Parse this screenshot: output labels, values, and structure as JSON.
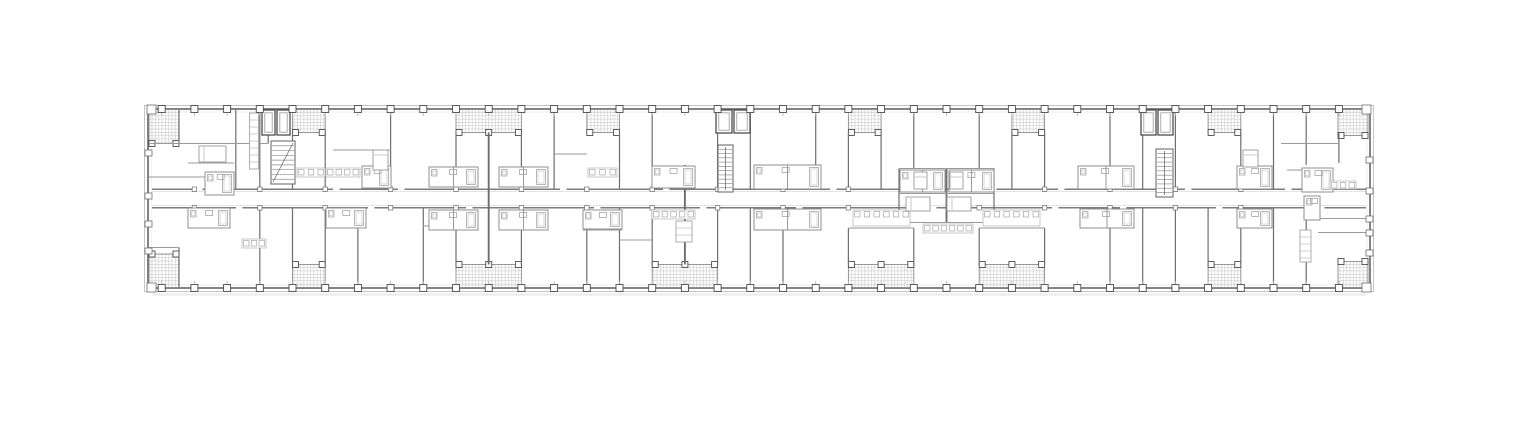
{
  "canvas": {
    "width": 1520,
    "height": 435,
    "background": "#ffffff"
  },
  "plan": {
    "type": "architectural-floor-plan",
    "style": {
      "wall": "#6e6e6e",
      "roomWall": "#9a9a9a",
      "thinWall": "#8f8f8f",
      "fine": "#b3b3b3",
      "hatch": "#c9c9c9",
      "balconyBorder": "#8d8d8d",
      "colStroke": "#4e4e4e",
      "corridor": "#7c7c7c",
      "corridorInner": "#dcdcdc",
      "outerLight": "#c6c6c6",
      "innerFace": "#e6e6e6",
      "fixture": "#9a9a9a",
      "ground": "#ededed",
      "paper": "#ffffff"
    },
    "building": {
      "outer": {
        "x": 144.5,
        "y": 105.5,
        "w": 1229,
        "h": 186
      },
      "inner": {
        "x": 148,
        "y": 109,
        "w": 1222,
        "h": 179
      },
      "groundY": 294.5
    },
    "grid": {
      "columns": [
        161.7,
        194.4,
        227.1,
        259.8,
        292.5,
        325.2,
        357.9,
        390.6,
        423.3,
        456,
        488.7,
        521.4,
        554.1,
        586.8,
        619.5,
        652.2,
        684.9,
        717.6,
        750.3,
        783,
        815.7,
        848.4,
        881.1,
        913.8,
        946.5,
        979.2,
        1011.9,
        1044.6,
        1077.3,
        1110,
        1142.7,
        1175.4,
        1208.1,
        1240.8,
        1273.5,
        1306.2,
        1338.9
      ],
      "colSize": 7,
      "topY": 109,
      "bottomY": 288
    },
    "corridor": {
      "x1": 152,
      "x2": 1366,
      "topY": 189.2,
      "botY": 207.8,
      "gapW": 6.5,
      "topGaps": [
        196,
        333,
        398,
        560,
        663,
        830,
        990,
        1058,
        1185,
        1285
      ],
      "botGaps": [
        236,
        368,
        466,
        594,
        700,
        796,
        930,
        1052,
        1120,
        1216,
        1318
      ]
    },
    "balconies": {
      "top": [
        {
          "x": 149,
          "y": 109.5,
          "w": 30,
          "h": 34
        },
        {
          "x": 292.5,
          "y": 109.5,
          "w": 32.7,
          "h": 23
        },
        {
          "x": 456,
          "y": 109.5,
          "w": 65.4,
          "h": 23,
          "mid": 488.7
        },
        {
          "x": 586.8,
          "y": 109.5,
          "w": 32.7,
          "h": 23
        },
        {
          "x": 848.4,
          "y": 109.5,
          "w": 32.7,
          "h": 23
        },
        {
          "x": 1011.9,
          "y": 109.5,
          "w": 32.7,
          "h": 23
        },
        {
          "x": 1208.1,
          "y": 109.5,
          "w": 32.7,
          "h": 23
        },
        {
          "x": 1338,
          "y": 109.5,
          "w": 30,
          "h": 26
        }
      ],
      "bottom": [
        {
          "x": 149,
          "y": 254,
          "w": 30,
          "h": 33.5
        },
        {
          "x": 292.5,
          "y": 264.5,
          "w": 32.7,
          "h": 23
        },
        {
          "x": 456,
          "y": 264.5,
          "w": 65.4,
          "h": 23,
          "mid": 488.7
        },
        {
          "x": 652.2,
          "y": 264.5,
          "w": 65.4,
          "h": 23,
          "mid": 684.9
        },
        {
          "x": 848.4,
          "y": 264.5,
          "w": 65.4,
          "h": 23,
          "mid": 881.1
        },
        {
          "x": 979.2,
          "y": 264.5,
          "w": 65.4,
          "h": 23,
          "mid": 1011.9
        },
        {
          "x": 1208.1,
          "y": 264.5,
          "w": 32.7,
          "h": 23
        },
        {
          "x": 1338,
          "y": 261.5,
          "w": 30,
          "h": 26
        }
      ]
    },
    "wallsV": [
      {
        "x": 179,
        "y1": 110,
        "y2": 143.5
      },
      {
        "x": 268.2,
        "y1": 110,
        "y2": 143.5
      },
      {
        "x": 235.8,
        "y1": 110,
        "y2": 189
      },
      {
        "x": 259.8,
        "y1": 110,
        "y2": 189
      },
      {
        "x": 292.5,
        "y1": 132.5,
        "y2": 189
      },
      {
        "x": 325.2,
        "y1": 132.5,
        "y2": 189
      },
      {
        "x": 390.6,
        "y1": 110,
        "y2": 189
      },
      {
        "x": 456,
        "y1": 132.5,
        "y2": 189
      },
      {
        "x": 521.4,
        "y1": 132.5,
        "y2": 189
      },
      {
        "x": 554.1,
        "y1": 110,
        "y2": 189
      },
      {
        "x": 619.5,
        "y1": 132.5,
        "y2": 189
      },
      {
        "x": 652.2,
        "y1": 110,
        "y2": 189
      },
      {
        "x": 717.6,
        "y1": 110,
        "y2": 189
      },
      {
        "x": 750.3,
        "y1": 110,
        "y2": 189
      },
      {
        "x": 815.7,
        "y1": 110,
        "y2": 189
      },
      {
        "x": 848.4,
        "y1": 132.5,
        "y2": 189
      },
      {
        "x": 881.1,
        "y1": 132.5,
        "y2": 189
      },
      {
        "x": 913.8,
        "y1": 110,
        "y2": 168.5
      },
      {
        "x": 979.2,
        "y1": 110,
        "y2": 168.5
      },
      {
        "x": 1011.9,
        "y1": 132.5,
        "y2": 189
      },
      {
        "x": 1044.6,
        "y1": 132.5,
        "y2": 189
      },
      {
        "x": 1110,
        "y1": 110,
        "y2": 189
      },
      {
        "x": 1142.7,
        "y1": 110,
        "y2": 189
      },
      {
        "x": 1175.4,
        "y1": 110,
        "y2": 189
      },
      {
        "x": 1240.8,
        "y1": 132.5,
        "y2": 189
      },
      {
        "x": 1273.5,
        "y1": 110,
        "y2": 189
      },
      {
        "x": 1306.2,
        "y1": 110,
        "y2": 165
      },
      {
        "x": 1338.9,
        "y1": 133,
        "y2": 163
      },
      {
        "x": 259.8,
        "y1": 208,
        "y2": 287
      },
      {
        "x": 292.5,
        "y1": 208,
        "y2": 264.5
      },
      {
        "x": 325.2,
        "y1": 208,
        "y2": 264.5
      },
      {
        "x": 357.9,
        "y1": 208,
        "y2": 287
      },
      {
        "x": 423.3,
        "y1": 208,
        "y2": 287
      },
      {
        "x": 456,
        "y1": 208,
        "y2": 264.5
      },
      {
        "x": 521.4,
        "y1": 208,
        "y2": 264.5
      },
      {
        "x": 586.8,
        "y1": 208,
        "y2": 287
      },
      {
        "x": 619.5,
        "y1": 208,
        "y2": 287
      },
      {
        "x": 652.2,
        "y1": 208,
        "y2": 264.5
      },
      {
        "x": 717.6,
        "y1": 208,
        "y2": 264.5
      },
      {
        "x": 750.3,
        "y1": 208,
        "y2": 287
      },
      {
        "x": 783,
        "y1": 208,
        "y2": 287
      },
      {
        "x": 848.4,
        "y1": 228,
        "y2": 264.5
      },
      {
        "x": 913.8,
        "y1": 228,
        "y2": 264.5
      },
      {
        "x": 979.2,
        "y1": 228,
        "y2": 264.5
      },
      {
        "x": 1044.6,
        "y1": 228,
        "y2": 264.5
      },
      {
        "x": 1110,
        "y1": 208,
        "y2": 287
      },
      {
        "x": 1142.7,
        "y1": 208,
        "y2": 287
      },
      {
        "x": 1175.4,
        "y1": 208,
        "y2": 287
      },
      {
        "x": 1208.1,
        "y1": 208,
        "y2": 264.5
      },
      {
        "x": 1240.8,
        "y1": 208,
        "y2": 264.5
      },
      {
        "x": 1273.5,
        "y1": 208,
        "y2": 287
      },
      {
        "x": 1306.2,
        "y1": 208,
        "y2": 287
      },
      {
        "x": 179,
        "y1": 247.5,
        "y2": 287
      },
      {
        "x": 196,
        "y1": 208,
        "y2": 228
      },
      {
        "x": 488.7,
        "y1": 132.5,
        "y2": 264.5,
        "w": 1.9
      },
      {
        "x": 684.9,
        "y1": 165,
        "y2": 264.5,
        "w": 1.9
      },
      {
        "x": 946.5,
        "y1": 168.5,
        "y2": 222.5,
        "w": 1.9
      },
      {
        "x": 899,
        "y1": 168.5,
        "y2": 222.5
      },
      {
        "x": 994,
        "y1": 168.5,
        "y2": 222.5
      }
    ],
    "wallsH": [
      {
        "y": 143.5,
        "x1": 149,
        "x2": 268
      },
      {
        "y": 163,
        "x1": 188,
        "x2": 234
      },
      {
        "y": 177,
        "x1": 149,
        "x2": 234
      },
      {
        "y": 247.5,
        "x1": 149,
        "x2": 179
      },
      {
        "y": 143.5,
        "x1": 1281,
        "x2": 1338
      },
      {
        "y": 168.5,
        "x1": 899,
        "x2": 994
      },
      {
        "y": 193.5,
        "x1": 899,
        "x2": 994
      },
      {
        "y": 222.5,
        "x1": 899,
        "x2": 994
      },
      {
        "y": 228,
        "x1": 849,
        "x2": 914
      },
      {
        "y": 228,
        "x1": 979,
        "x2": 1045
      },
      {
        "y": 230,
        "x1": 583,
        "x2": 622
      },
      {
        "y": 218.5,
        "x1": 1318,
        "x2": 1366
      },
      {
        "y": 232.5,
        "x1": 1318,
        "x2": 1366
      },
      {
        "y": 170,
        "x1": 1287,
        "x2": 1302
      },
      {
        "y": 150,
        "x1": 333,
        "x2": 391
      },
      {
        "y": 154,
        "x1": 554,
        "x2": 587
      },
      {
        "y": 226,
        "x1": 423,
        "x2": 456
      },
      {
        "y": 240,
        "x1": 619,
        "x2": 652
      }
    ],
    "clusters": [
      {
        "t": "bath",
        "x": 205,
        "y": 172,
        "w": 29,
        "h": 23
      },
      {
        "t": "bath",
        "x": 188,
        "y": 208,
        "w": 42,
        "h": 20
      },
      {
        "t": "kitchen",
        "x": 242,
        "y": 239,
        "w": 24,
        "h": 9
      },
      {
        "t": "closet",
        "x": 249.5,
        "y": 113,
        "w": 9,
        "h": 56
      },
      {
        "t": "kitchen",
        "x": 297,
        "y": 168,
        "w": 28,
        "h": 9
      },
      {
        "t": "kitchen",
        "x": 326,
        "y": 168,
        "w": 34,
        "h": 9
      },
      {
        "t": "bath",
        "x": 362,
        "y": 166,
        "w": 29,
        "h": 22
      },
      {
        "t": "bath",
        "x": 326,
        "y": 208,
        "w": 40,
        "h": 20
      },
      {
        "t": "bath",
        "x": 429,
        "y": 167,
        "w": 49,
        "h": 20
      },
      {
        "t": "bath",
        "x": 499,
        "y": 167,
        "w": 49,
        "h": 20
      },
      {
        "t": "bath",
        "x": 429,
        "y": 210,
        "w": 49,
        "h": 20
      },
      {
        "t": "bath",
        "x": 499,
        "y": 210,
        "w": 49,
        "h": 20
      },
      {
        "t": "kitchen",
        "x": 588,
        "y": 168,
        "w": 29,
        "h": 9
      },
      {
        "t": "bath",
        "x": 583,
        "y": 210,
        "w": 39,
        "h": 19
      },
      {
        "t": "bath",
        "x": 652,
        "y": 166,
        "w": 43,
        "h": 22
      },
      {
        "t": "kitchen",
        "x": 652,
        "y": 210,
        "w": 43,
        "h": 9
      },
      {
        "t": "closet",
        "x": 676,
        "y": 221,
        "w": 16,
        "h": 21
      },
      {
        "t": "bath",
        "x": 754,
        "y": 165,
        "w": 67,
        "h": 24
      },
      {
        "t": "bath",
        "x": 754,
        "y": 209,
        "w": 67,
        "h": 21
      },
      {
        "t": "bath",
        "x": 900,
        "y": 170,
        "w": 45,
        "h": 22
      },
      {
        "t": "bath",
        "x": 949,
        "y": 170,
        "w": 45,
        "h": 22
      },
      {
        "t": "kitchen",
        "x": 923,
        "y": 224,
        "w": 50,
        "h": 9
      },
      {
        "t": "kitchen",
        "x": 853,
        "y": 210,
        "w": 57,
        "h": 16
      },
      {
        "t": "kitchen",
        "x": 983,
        "y": 210,
        "w": 57,
        "h": 16
      },
      {
        "t": "bath",
        "x": 1078,
        "y": 166,
        "w": 56,
        "h": 23
      },
      {
        "t": "bath",
        "x": 1080,
        "y": 209,
        "w": 54,
        "h": 19
      },
      {
        "t": "bath",
        "x": 1237,
        "y": 166,
        "w": 35,
        "h": 23
      },
      {
        "t": "bath",
        "x": 1237,
        "y": 209,
        "w": 35,
        "h": 19
      },
      {
        "t": "bath",
        "x": 1302,
        "y": 168,
        "w": 31,
        "h": 24
      },
      {
        "t": "kitchen",
        "x": 1330,
        "y": 181,
        "w": 26,
        "h": 8
      },
      {
        "t": "bath",
        "x": 1304,
        "y": 196,
        "w": 16,
        "h": 24
      },
      {
        "t": "closet",
        "x": 1300,
        "y": 230,
        "w": 11,
        "h": 32
      }
    ],
    "beds": [
      {
        "x": 199,
        "y": 146,
        "w": 27,
        "h": 16,
        "dir": "h"
      },
      {
        "x": 373,
        "y": 150,
        "w": 15,
        "h": 20,
        "dir": "v"
      },
      {
        "x": 914,
        "y": 172,
        "w": 13,
        "h": 17,
        "dir": "v"
      },
      {
        "x": 950,
        "y": 172,
        "w": 13,
        "h": 17,
        "dir": "v"
      },
      {
        "x": 906,
        "y": 197,
        "w": 24,
        "h": 14,
        "dir": "h"
      },
      {
        "x": 947,
        "y": 197,
        "w": 24,
        "h": 14,
        "dir": "h"
      },
      {
        "x": 1243,
        "y": 150,
        "w": 15,
        "h": 17,
        "dir": "v"
      }
    ],
    "stairs": [
      {
        "x": 271,
        "y": 141,
        "w": 24,
        "h": 43,
        "treads": 9,
        "diag": true
      },
      {
        "x": 718,
        "y": 145,
        "w": 15,
        "h": 47,
        "treads": 11,
        "diag": false
      },
      {
        "x": 1156,
        "y": 149,
        "w": 17,
        "h": 48,
        "treads": 11,
        "diag": false
      }
    ],
    "elevators": [
      {
        "x": 262,
        "y": 110,
        "w": 13,
        "h": 25
      },
      {
        "x": 277,
        "y": 110,
        "w": 13,
        "h": 25
      },
      {
        "x": 716,
        "y": 110,
        "w": 16,
        "h": 23
      },
      {
        "x": 734,
        "y": 110,
        "w": 16,
        "h": 23
      },
      {
        "x": 1141,
        "y": 110,
        "w": 15,
        "h": 25
      },
      {
        "x": 1158,
        "y": 110,
        "w": 15,
        "h": 25
      }
    ],
    "wallTicks": [
      {
        "x": 147,
        "y": 105,
        "w": 9,
        "h": 9
      },
      {
        "x": 1362,
        "y": 105,
        "w": 9,
        "h": 9
      },
      {
        "x": 147,
        "y": 283,
        "w": 9,
        "h": 9
      },
      {
        "x": 1362,
        "y": 283,
        "w": 9,
        "h": 9
      },
      {
        "x": 145,
        "y": 150,
        "w": 7,
        "h": 6
      },
      {
        "x": 145,
        "y": 193,
        "w": 7,
        "h": 6
      },
      {
        "x": 145,
        "y": 221,
        "w": 7,
        "h": 6
      },
      {
        "x": 145,
        "y": 248,
        "w": 7,
        "h": 6
      },
      {
        "x": 1366,
        "y": 157,
        "w": 7,
        "h": 6
      },
      {
        "x": 1366,
        "y": 188,
        "w": 7,
        "h": 6
      },
      {
        "x": 1366,
        "y": 216,
        "w": 7,
        "h": 6
      },
      {
        "x": 1366,
        "y": 230,
        "w": 7,
        "h": 6
      },
      {
        "x": 1366,
        "y": 250,
        "w": 7,
        "h": 6
      }
    ]
  }
}
